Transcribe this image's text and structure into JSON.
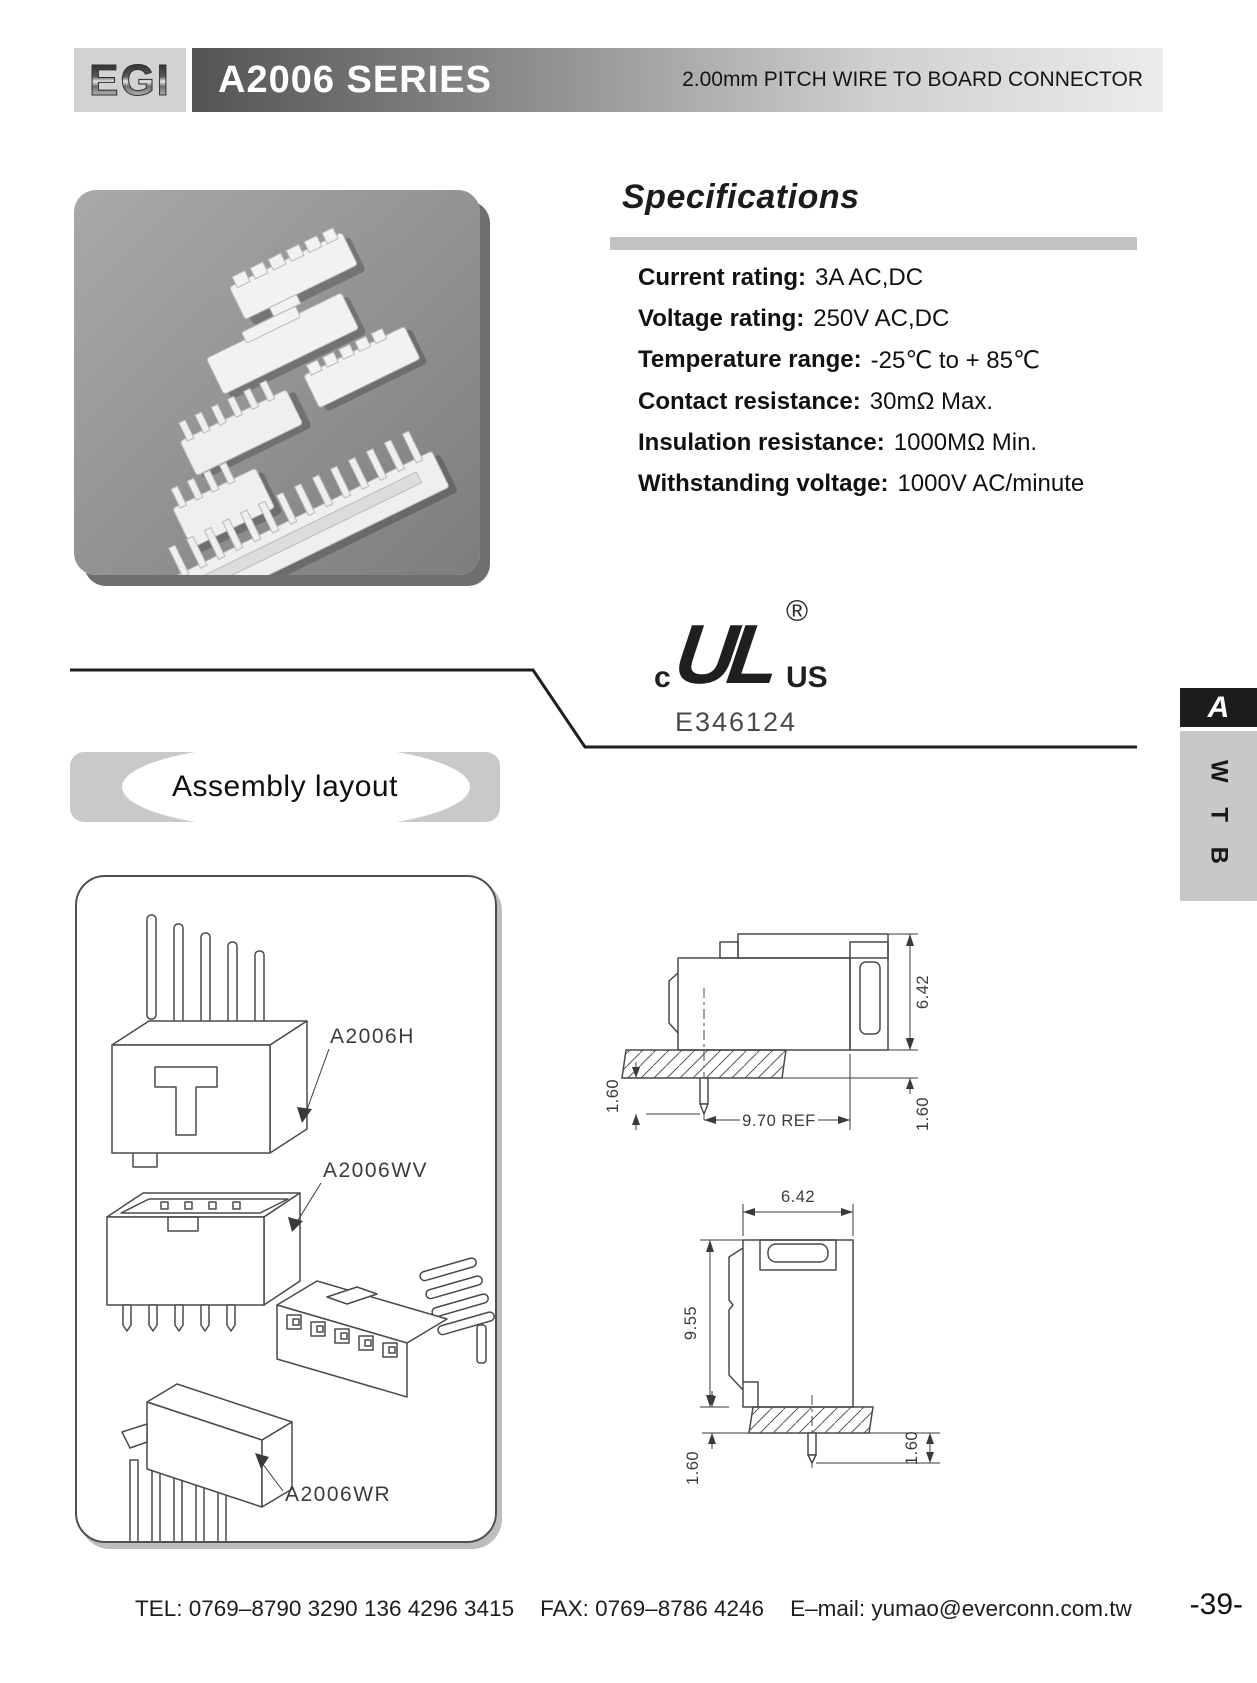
{
  "header": {
    "logo_text": "EGI",
    "series_title": "A2006 SERIES",
    "subtitle": "2.00mm PITCH WIRE TO BOARD CONNECTOR"
  },
  "specifications": {
    "title": "Specifications",
    "items": [
      {
        "label": "Current rating:",
        "value": "3A AC,DC"
      },
      {
        "label": "Voltage rating:",
        "value": "250V AC,DC"
      },
      {
        "label": "Temperature range:",
        "value": "-25℃ to + 85℃"
      },
      {
        "label": "Contact resistance:",
        "value": "30mΩ Max."
      },
      {
        "label": "Insulation resistance:",
        "value": "1000MΩ Min."
      },
      {
        "label": "Withstanding voltage:",
        "value": "1000V AC/minute"
      }
    ]
  },
  "certification": {
    "prefix": "c",
    "monogram": "UL",
    "suffix": "US",
    "registered_symbol": "®",
    "file_number": "E346124"
  },
  "assembly": {
    "section_title": "Assembly layout",
    "labels": {
      "header_part": "A2006H",
      "vertical_part": "A2006WV",
      "right_angle_part": "A2006WR"
    }
  },
  "dimension_drawings": {
    "side_view": {
      "height": "6.42",
      "pin_protrusion": "1.60",
      "board_thickness": "1.60",
      "width_ref": "9.70 REF"
    },
    "front_view": {
      "width": "6.42",
      "height": "9.55",
      "board_thickness": "1.60",
      "pin_protrusion": "1.60"
    }
  },
  "side_tab": {
    "section_letter": "A",
    "category": "W T B"
  },
  "footer": {
    "tel": "TEL: 0769–8790 3290  136 4296 3415",
    "fax": "FAX: 0769–8786 4246",
    "email": "E–mail: yumao@everconn.com.tw",
    "page_number": "-39-"
  },
  "colors": {
    "header_gradient_start": "#545456",
    "header_gradient_end": "#ececec",
    "spec_bar_gray": "#c2c2c2",
    "tab_black": "#1c1c1c",
    "tab_gray": "#c8c8c8",
    "photo_gray": "#8f8f8f"
  }
}
